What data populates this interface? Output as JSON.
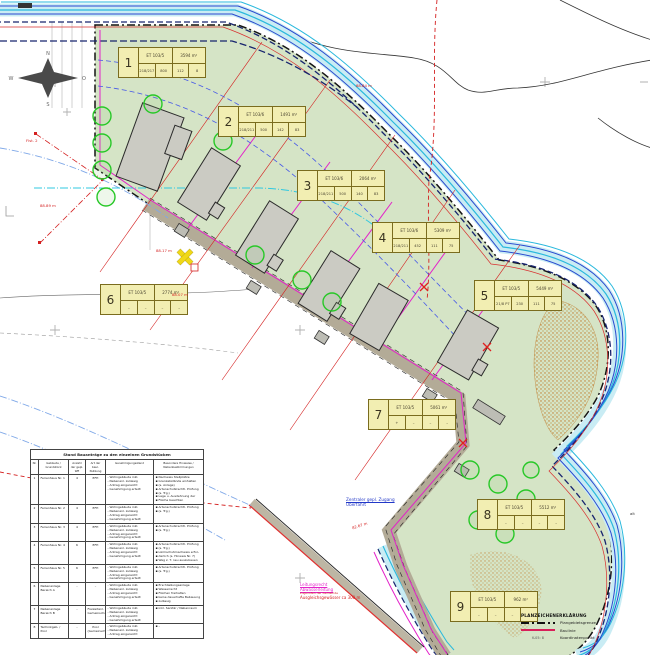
{
  "plots": [
    {
      "num": "1",
      "flst": "ET 103/5",
      "area": "3594 m²",
      "c": [
        "218/217",
        "800",
        "112",
        "8"
      ]
    },
    {
      "num": "2",
      "flst": "ET 103/6",
      "area": "1491 m²",
      "c": [
        "218/211",
        "500",
        "142",
        "83"
      ]
    },
    {
      "num": "3",
      "flst": "ET 103/6",
      "area": "2064 m²",
      "c": [
        "218/211",
        "500",
        "140",
        "83"
      ]
    },
    {
      "num": "4",
      "flst": "ET 103/6",
      "area": "5309 m²",
      "c": [
        "218/211",
        "452",
        "111",
        "75"
      ]
    },
    {
      "num": "5",
      "flst": "ET 103/5",
      "area": "5449 m²",
      "c": [
        "21/8 P7",
        "230",
        "111",
        "75"
      ]
    },
    {
      "num": "6",
      "flst": "ET 103/5",
      "area": "2774 m²",
      "c": [
        "–",
        "–",
        "–",
        "–"
      ]
    },
    {
      "num": "7",
      "flst": "ET 103/5",
      "area": "5061 m²",
      "c": [
        "+",
        "–",
        "–",
        "–"
      ]
    },
    {
      "num": "8",
      "flst": "ET 103/5",
      "area": "5512 m²",
      "c": [
        "–",
        "–",
        "–",
        "–"
      ]
    },
    {
      "num": "9",
      "flst": "ET 103/5",
      "area": "962 m²",
      "c": [
        "–",
        "–",
        "–",
        "–"
      ]
    }
  ],
  "annotations": {
    "access_line1": "Zentraler gepl. Zugang",
    "access_line2": "Überfahrt",
    "utility_line1": "Leitungsrecht",
    "utility_line2": "Abwasserleitung",
    "utility_line3": "zugunsten der Gemeinde",
    "utility_line4": "Ausgleichsgewässer ca 300 m",
    "dims": [
      {
        "t": "88.84 m"
      },
      {
        "t": "Flst. 2"
      },
      {
        "t": "88.89 m"
      },
      {
        "t": "88.17 m"
      },
      {
        "t": "88.07 m"
      },
      {
        "t": "82.67 m"
      },
      {
        "t": "alt"
      }
    ]
  },
  "compass": {
    "n": "N",
    "e": "O",
    "s": "S",
    "w": "W"
  },
  "table": {
    "title": "Stand Bauanträge zu den einzelnen Grundstücken",
    "headers": [
      "Nr.",
      "Gebäude / Grundstück",
      "Anzahl der gepl. WE",
      "Art der baul. Nutzung",
      "Genehmigungsstand",
      "Besondere Hinweise / Nebenbestimmungen"
    ],
    "rows": [
      {
        "nr": "1",
        "name": "Ferienhaus Nr. 1",
        "we": "4",
        "art": "EFH",
        "stand": [
          "Wohngebäude inkl.",
          "Nebenanl. zulässig",
          "Antrag eingereicht",
          "Genehmigung erteilt"
        ],
        "hinw": [
          "Nachweis Stellplätze",
          "Grenzabstände einhalten",
          "(s. Anlage)",
          "Artenschutzrechtl. Prüfung",
          "(s. Trg.)",
          "Lage u. Ausdehnung der",
          "Fläche beachten"
        ]
      },
      {
        "nr": "2",
        "name": "Ferienhaus Nr. 2",
        "we": "4",
        "art": "EFH",
        "stand": [
          "Wohngebäude inkl.",
          "Nebenanl. zulässig",
          "Antrag eingereicht",
          "Genehmigung erteilt"
        ],
        "hinw": [
          "Artenschutzrechtl. Prüfung",
          "(s. Trg.)"
        ]
      },
      {
        "nr": "3",
        "name": "Ferienhaus Nr. 3",
        "we": "4",
        "art": "EFH",
        "stand": [
          "Wohngebäude inkl.",
          "Nebenanl. zulässig",
          "Antrag eingereicht",
          "Genehmigung erteilt"
        ],
        "hinw": [
          "Artenschutzrechtl. Prüfung",
          "(s. Trg.)"
        ]
      },
      {
        "nr": "4",
        "name": "Ferienhaus Nr. 4",
        "we": "6",
        "art": "EFH",
        "stand": [
          "Wohngebäude inkl.",
          "Nebenanl. zulässig",
          "Antrag eingereicht",
          "Genehmigung erteilt"
        ],
        "hinw": [
          "Artenschutzrechtl. Prüfung",
          "(s. Trg.)",
          "Lärmschutznachweis erfor-",
          "derlich (s. Hinweis Nr. 7)",
          "Weg z. T. neu auszubauen"
        ]
      },
      {
        "nr": "5",
        "name": "Ferienhaus Nr. 5",
        "we": "6",
        "art": "EFH",
        "stand": [
          "Wohngebäude inkl.",
          "Nebenanl. zulässig",
          "Antrag eingereicht",
          "Genehmigung erteilt"
        ],
        "hinw": [
          "Artenschutzrechtl. Prüfung",
          "(s. Trg.)"
        ]
      },
      {
        "nr": "6",
        "name": "Nebenanlage Bereich A",
        "we": "–",
        "art": "–",
        "stand": [
          "Wohngebäude inkl.",
          "Nebenanl. zulässig",
          "Antrag eingereicht",
          "Genehmigung erteilt"
        ],
        "hinw": [
          "Erschließungsanlage",
          "Wasserrecht",
          "Flächen freihalten",
          "keine dauerhafte Bebauung",
          "zulässig"
        ]
      },
      {
        "nr": "7",
        "name": "Nebenanlage Bereich B",
        "we": "–",
        "art": "Freizeitanl. Gemeinschaftshaus",
        "stand": [
          "Wohngebäude inkl.",
          "Nebenanl. zulässig",
          "Antrag eingereicht",
          "Genehmigung erteilt"
        ],
        "hinw": [
          "inkl. Sanitär / Nebenraum"
        ]
      },
      {
        "nr": "8",
        "name": "Technikgeb. / Pool",
        "we": "–",
        "art": "Pool (Gemeinschaft)",
        "stand": [
          "Wohngebäude inkl.",
          "Nebenanl. zulässig",
          "Antrag eingereicht"
        ],
        "hinw": [
          "–"
        ]
      }
    ]
  },
  "legend": {
    "title": "PLANZEICHENERKLÄRUNG",
    "items": [
      {
        "label": "Plangebietsgrenze"
      },
      {
        "label": "Baulinie"
      },
      {
        "sample": "K-05: 8",
        "label": "Koordinatenpunkt"
      }
    ]
  },
  "colors": {
    "site_green": "#d5e4c6",
    "plot_label_bg": "#f2eeb2",
    "boundary_black": "#141414",
    "stream_cyan": "#2ab9dd",
    "stream_blue": "#2a49cf",
    "stream_navy": "#17246e",
    "magenta": "#e322c9",
    "dim_red": "#d42020",
    "road_gray": "#b3ab97",
    "legend_crimson": "#d8205a"
  }
}
